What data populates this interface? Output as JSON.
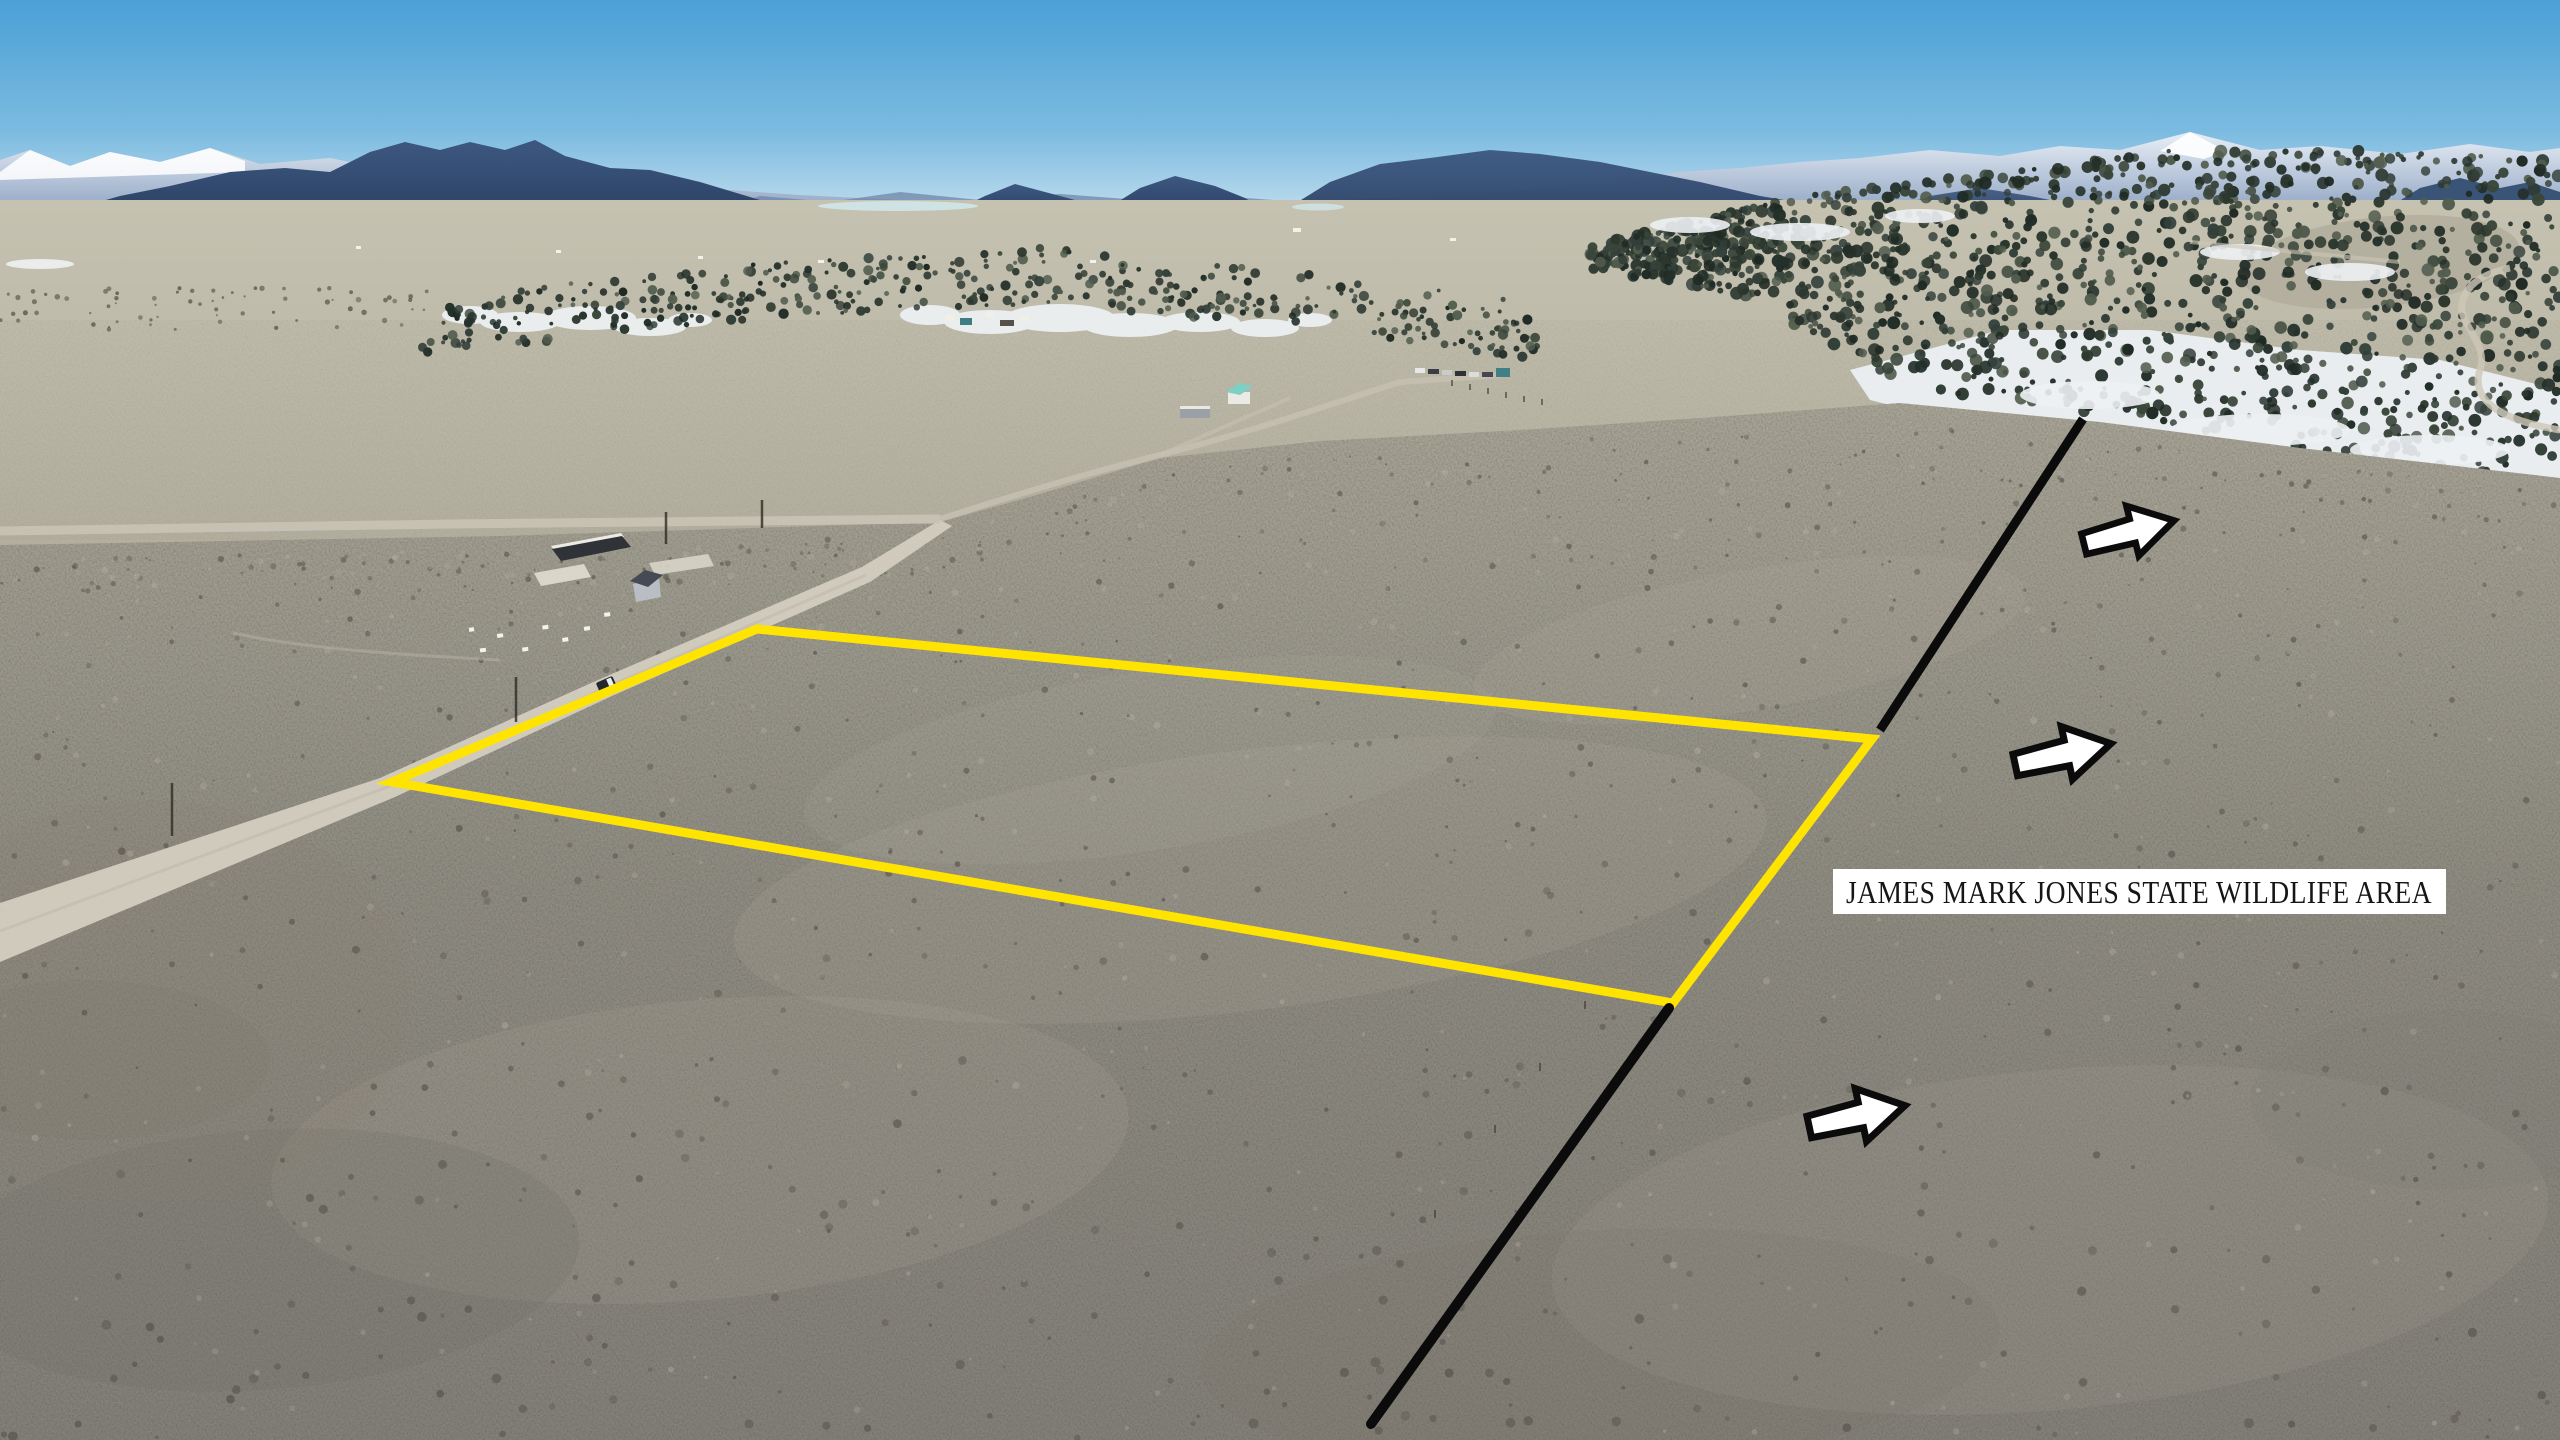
{
  "scene": {
    "kind_label": "annotated aerial land photo"
  },
  "annotations": {
    "wildlife_area_label": {
      "text": "JAMES MARK JONES STATE WILDLIFE AREA",
      "background": "#ffffff",
      "text_color": "#161616"
    },
    "parcel_outline": {
      "color": "#ffe402"
    },
    "boundary_line": {
      "color": "#0b0b0b",
      "segments": 2
    },
    "direction_arrows": {
      "fill": "#ffffff",
      "outline": "#0b0b0b",
      "count": 3,
      "direction": "right"
    }
  },
  "palette": {
    "sky_top": "#4aa0d6",
    "sky_horizon": "#d9e9f3",
    "mountains": "#3d5880",
    "plains": "#b8b4a4",
    "foreground": "#8b887e",
    "snow": "#eef1f4",
    "forest": "#2c372e",
    "road": "#d3cdc0"
  }
}
